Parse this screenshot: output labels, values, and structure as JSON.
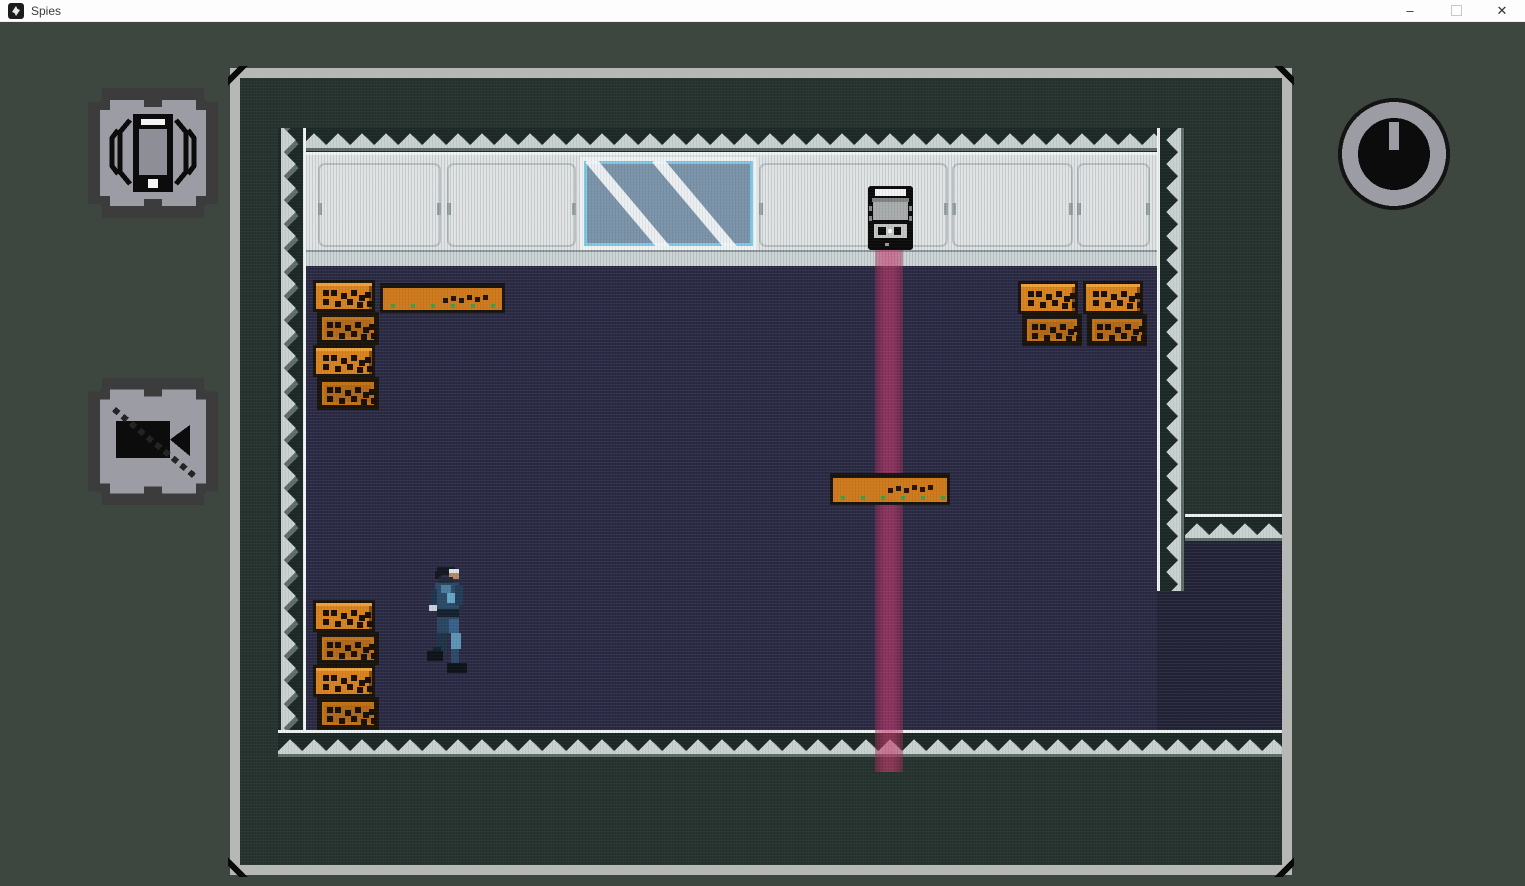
{
  "window": {
    "title": "Spies"
  },
  "titlebar": {
    "app_icon": "spies-logo-icon",
    "minimize_glyph": "–",
    "close_glyph": "✕"
  },
  "hud": {
    "left_icons": [
      "phone-vibrate-icon",
      "camera-off-icon"
    ],
    "right_icons": [
      "timer-clock-icon"
    ]
  },
  "colors": {
    "titlebar_bg": "#fdfdfd",
    "page_bg": "#3e4640",
    "frame_grey": "#b6b8b6",
    "outside_teal": "#26332e",
    "corridor_white": "#dfe3e3",
    "floor_navy": "#2a2a45",
    "wall_dark": "#1c2926",
    "wall_light": "#c9d2d1",
    "crate_orange": "#d9831f",
    "crate_dark_orange": "#b2691a",
    "window_cyan": "#7ec8e8",
    "glass_blue": "#7b94a9",
    "laser_red": "#c43a6c",
    "icon_grey": "#9c9ca4"
  },
  "level": {
    "entities": [
      {
        "type": "glass-window",
        "x": 340,
        "y": 79,
        "w": 177,
        "h": 93
      },
      {
        "type": "laser-beam",
        "x": 635,
        "y": 172,
        "w": 28,
        "h": 522
      },
      {
        "type": "robot",
        "x": 628,
        "y": 108,
        "w": 45,
        "h": 64
      },
      {
        "type": "table",
        "x": 140,
        "y": 205,
        "w": 125,
        "h": 30
      },
      {
        "type": "table",
        "x": 590,
        "y": 395,
        "w": 120,
        "h": 32
      },
      {
        "type": "crate",
        "variant": "bright",
        "x": 73,
        "y": 202,
        "w": 62,
        "h": 32
      },
      {
        "type": "crate",
        "variant": "dark",
        "x": 77,
        "y": 234,
        "w": 62,
        "h": 33
      },
      {
        "type": "crate",
        "variant": "bright",
        "x": 73,
        "y": 267,
        "w": 62,
        "h": 32
      },
      {
        "type": "crate",
        "variant": "dark",
        "x": 77,
        "y": 299,
        "w": 62,
        "h": 33
      },
      {
        "type": "crate",
        "variant": "bright",
        "x": 778,
        "y": 203,
        "w": 60,
        "h": 33
      },
      {
        "type": "crate",
        "variant": "dark",
        "x": 782,
        "y": 236,
        "w": 60,
        "h": 32
      },
      {
        "type": "crate",
        "variant": "bright",
        "x": 843,
        "y": 203,
        "w": 60,
        "h": 33
      },
      {
        "type": "crate",
        "variant": "dark",
        "x": 847,
        "y": 236,
        "w": 60,
        "h": 32
      },
      {
        "type": "crate",
        "variant": "bright",
        "x": 73,
        "y": 522,
        "w": 62,
        "h": 32
      },
      {
        "type": "crate",
        "variant": "dark",
        "x": 77,
        "y": 554,
        "w": 62,
        "h": 33
      },
      {
        "type": "crate",
        "variant": "bright",
        "x": 73,
        "y": 587,
        "w": 62,
        "h": 32
      },
      {
        "type": "crate",
        "variant": "dark",
        "x": 77,
        "y": 619,
        "w": 62,
        "h": 33
      },
      {
        "type": "player",
        "x": 185,
        "y": 487,
        "w": 46,
        "h": 115
      }
    ]
  }
}
